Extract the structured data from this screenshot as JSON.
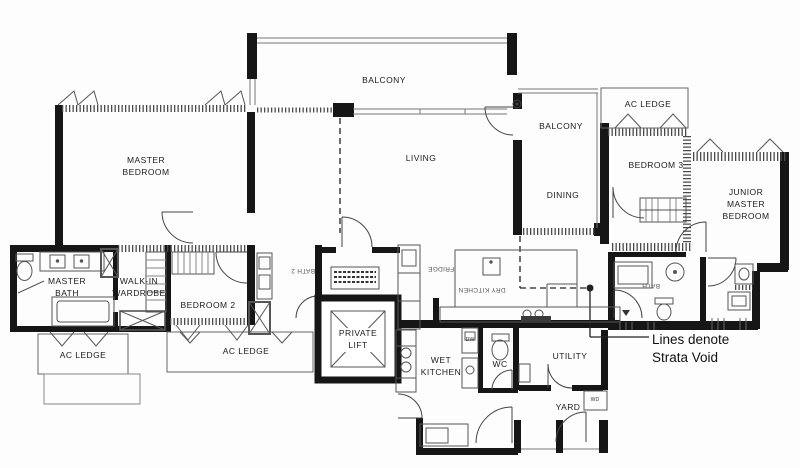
{
  "title": "Apartment floor plan",
  "rooms": {
    "master_bedroom": "MASTER BEDROOM",
    "balcony_top": "BALCONY",
    "living": "LIVING",
    "balcony_right": "BALCONY",
    "ac_ledge_top_right": "AC LEDGE",
    "bedroom_3": "BEDROOM 3",
    "dining": "DINING",
    "junior_master_bedroom": "JUNIOR MASTER BEDROOM",
    "master_bath": "MASTER BATH",
    "walk_in_wardrobe": "WALK-IN WARDROBE",
    "bedroom_2": "BEDROOM 2",
    "ac_ledge_left": "AC LEDGE",
    "ac_ledge_center": "AC LEDGE",
    "private_lift": "PRIVATE LIFT",
    "wet_kitchen": "WET KITCHEN",
    "wc": "WC",
    "utility": "UTILITY",
    "yard": "YARD",
    "dry_kitchen": "DRY KITCHEN",
    "bath_2": "BATH 2",
    "jr_bath": "BATH"
  },
  "appliances": {
    "dishwasher": "DW",
    "washer_dryer": "WD",
    "fridge": "FRIDGE"
  },
  "annotation": {
    "strata_void_note": "Lines denote Strata Void"
  },
  "colors": {
    "wall": "#161616",
    "line": "#4a4a4a",
    "hatch": "#555555",
    "background": "#fdfdfd"
  }
}
